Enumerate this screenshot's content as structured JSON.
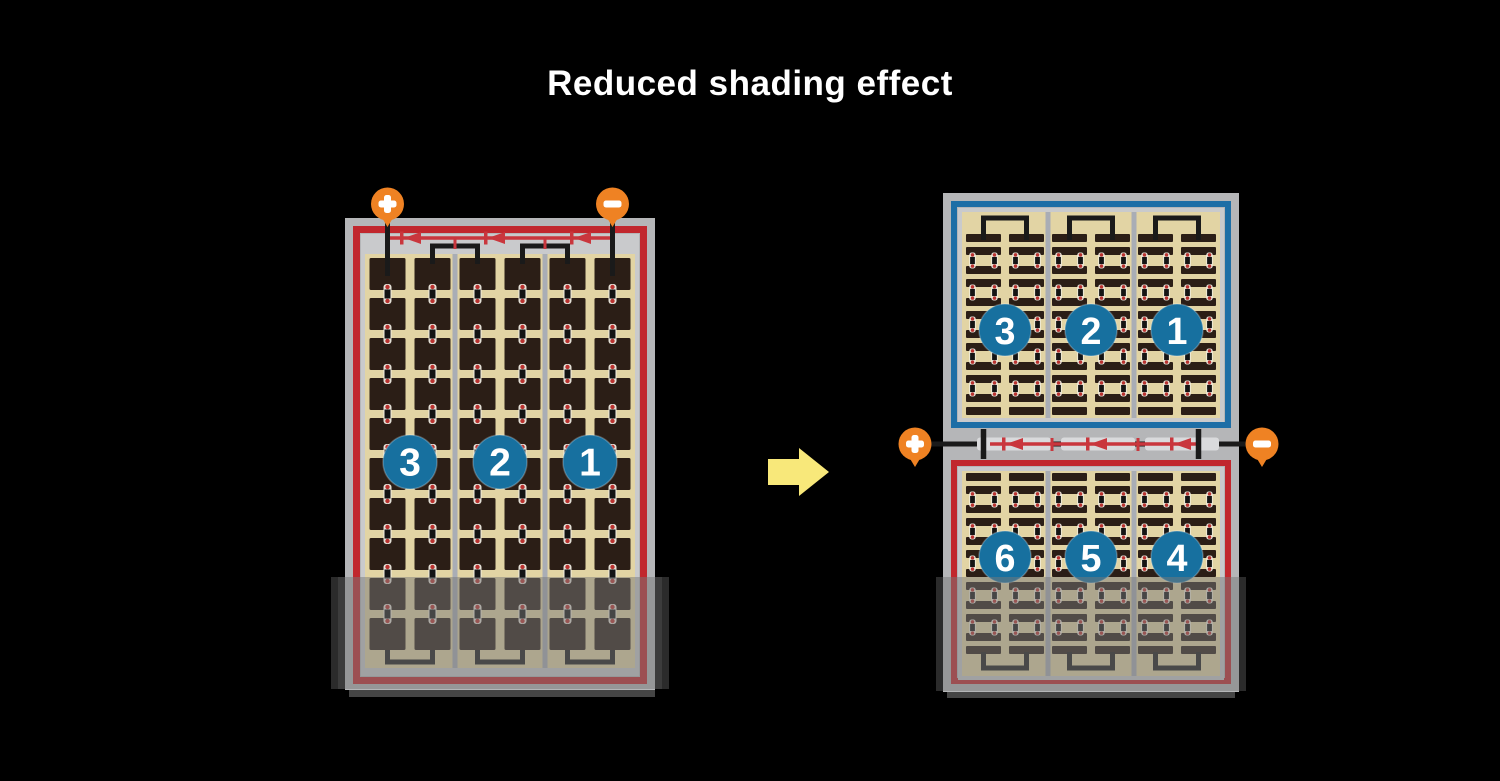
{
  "title": "Reduced shading effect",
  "arrow": {
    "direction": "right"
  },
  "left_module": {
    "border_color": "#c1272d",
    "sections": [
      {
        "label": "3"
      },
      {
        "label": "2"
      },
      {
        "label": "1"
      }
    ],
    "bypass_diode_count": 3,
    "terminals": [
      {
        "symbol": "+",
        "position": "top-left"
      },
      {
        "symbol": "-",
        "position": "top-right"
      }
    ],
    "shaded_region": "bottom"
  },
  "right_module": {
    "top_half": {
      "border_color": "#1d6ea6",
      "sections": [
        {
          "label": "3"
        },
        {
          "label": "2"
        },
        {
          "label": "1"
        }
      ]
    },
    "bottom_half": {
      "border_color": "#c1272d",
      "sections": [
        {
          "label": "6"
        },
        {
          "label": "5"
        },
        {
          "label": "4"
        }
      ]
    },
    "bypass_diode_count": 3,
    "terminals": [
      {
        "symbol": "+",
        "position": "middle-left"
      },
      {
        "symbol": "-",
        "position": "middle-right"
      }
    ],
    "shaded_region": "bottom"
  },
  "colors": {
    "background": "#000000",
    "title_text": "#ffffff",
    "frame_gray": "#b5b6b8",
    "inner_gray": "#c9cacc",
    "cell_field_tan": "#e2d4a4",
    "cell_dark": "#2b1e16",
    "divider_gray": "#a9adb5",
    "module_red": "#c1272d",
    "bus_red": "#c9363d",
    "module_blue": "#1d6ea6",
    "section_circle_blue": "#17709f",
    "terminal_orange": "#ef8223",
    "wire_black": "#1a1a1a",
    "arrow_yellow": "#f8e87a",
    "connector_dot_red": "#b9322f",
    "connector_halo": "#f5f2e8",
    "junction_segment": "#d9dadc",
    "shading_overlay": "rgba(120,120,120,0.5)",
    "shading_edge": "rgba(0,0,0,0.28)",
    "panel_shadow": "#454545"
  }
}
